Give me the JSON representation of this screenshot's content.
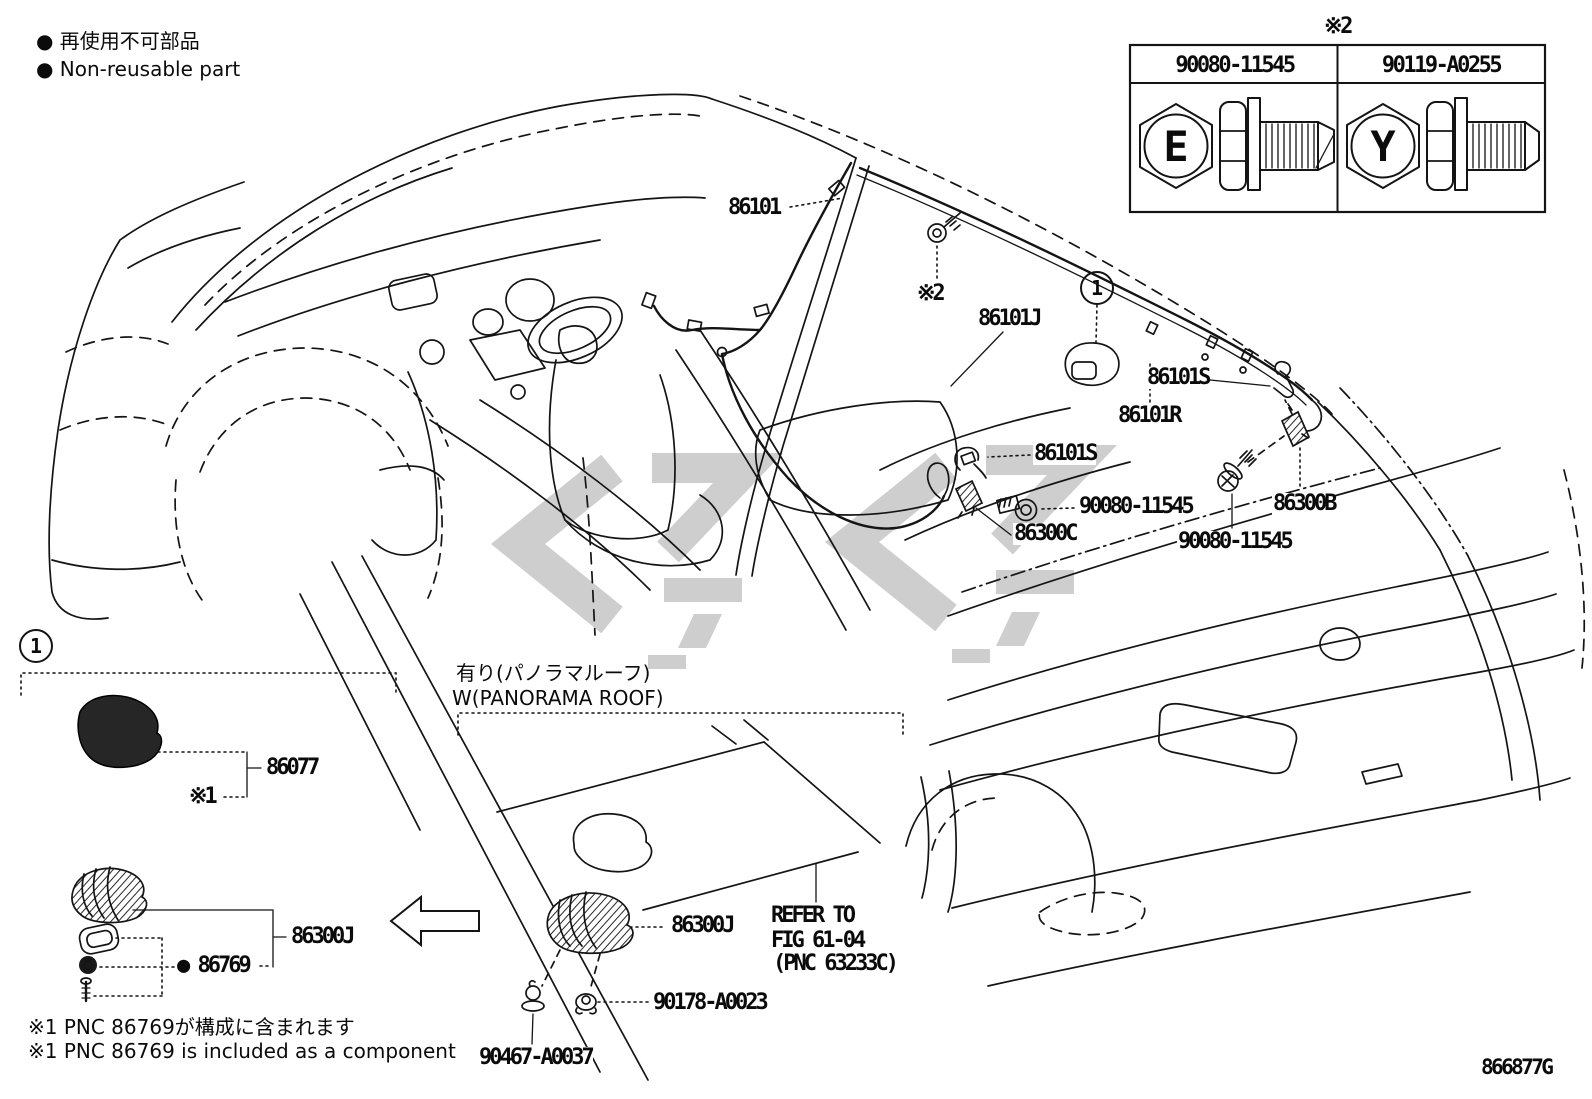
{
  "doc": {
    "number": "866877G"
  },
  "legend": {
    "jp": "● 再使用不可部品",
    "en": "● Non-reusable part"
  },
  "fastener_table": {
    "title": "※2",
    "col1": {
      "part_no": "90080-11545",
      "head_letter": "E"
    },
    "col2": {
      "part_no": "90119-A0255",
      "head_letter": "Y"
    }
  },
  "main": {
    "index1": "1",
    "l86101": "86101",
    "ref2": "※2",
    "l86101J": "86101J",
    "l86101S_a": "86101S",
    "l86101R": "86101R",
    "l86101S_b": "86101S",
    "l90080_a": "90080-11545",
    "l86300C": "86300C",
    "l86300B": "86300B",
    "l90080_b": "90080-11545"
  },
  "inset": {
    "index1": "1",
    "l86077": "86077",
    "ref1": "※1",
    "l86300J": "86300J",
    "l86769": "● 86769"
  },
  "panorama": {
    "jp": "有り(パノラマルーフ)",
    "en": "W(PANORAMA ROOF)",
    "l86300J": "86300J",
    "refer_1": "REFER TO",
    "refer_2": "FIG 61-04",
    "refer_3": "(PNC 63233C)",
    "l90178": "90178-A0023",
    "l90467": "90467-A0037"
  },
  "footnotes": {
    "jp": "※1 PNC 86769が構成に含まれます",
    "en": "※1 PNC 86769 is included as a component"
  }
}
